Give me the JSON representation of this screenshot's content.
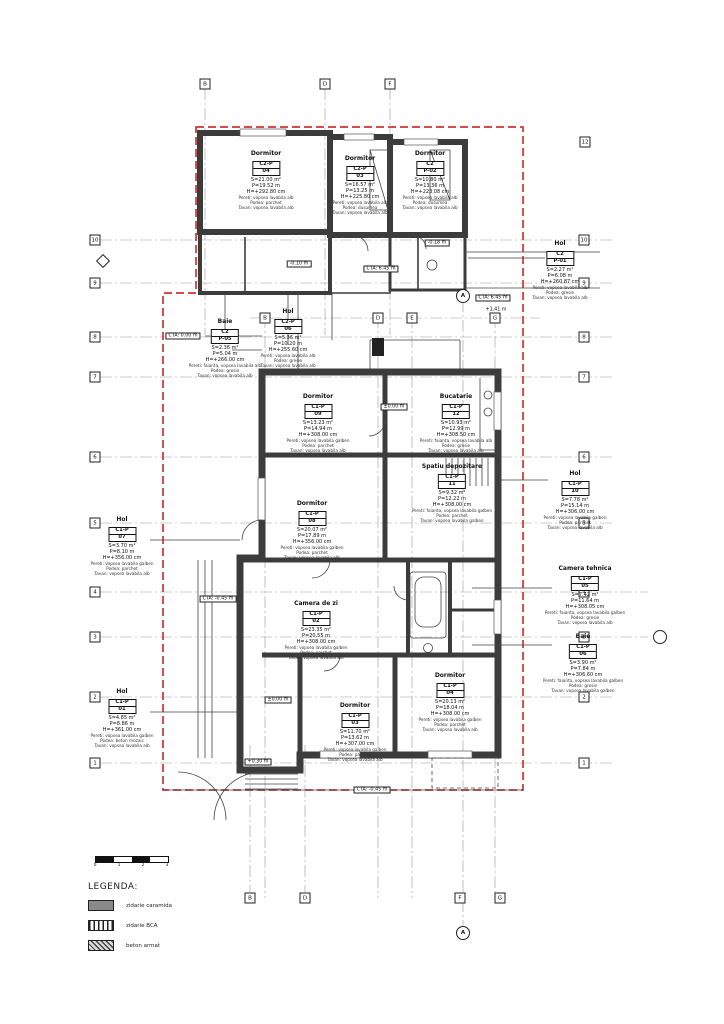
{
  "palette": {
    "boundary": "#cf3333",
    "wall": "#3c3c3c",
    "paper": "#ffffff"
  },
  "legend": {
    "title": "LEGENDA:",
    "items": [
      {
        "name": "zidarie caramida",
        "style": "solid"
      },
      {
        "name": "zidarie BCA",
        "style": "vlines"
      },
      {
        "name": "beton armat",
        "style": "hatch"
      }
    ]
  },
  "scalebar": {
    "ticks": [
      "0",
      "1",
      "2",
      "3"
    ]
  },
  "rooms": [
    {
      "name": "Dormitor",
      "code": "C2-P",
      "num": "04",
      "area": "S=21.00 m²",
      "per": "P=19.52 m",
      "h": "H=+292.80 cm",
      "f1": "Pereti: vopsea lavabila alb",
      "f2": "Podea: parchet",
      "f3": "Tavan: vopsea lavabila alb",
      "x": 266,
      "y": 150
    },
    {
      "name": "Dormitor",
      "code": "C2-P",
      "num": "03",
      "area": "S=16.57 m²",
      "per": "P=13.25 m",
      "h": "H=+225.80 cm",
      "f1": "Pereti: vopsea lavabila alb",
      "f2": "Podea: dusumea",
      "f3": "Tavan: vopsea lavabila alb",
      "x": 360,
      "y": 155
    },
    {
      "name": "Dormitor",
      "code": "C2",
      "num": "P-02",
      "area": "S=10.80 m²",
      "per": "P=13.36 m",
      "h": "H=+223.08 cm",
      "f1": "Pereti: vopsea lavabila alb",
      "f2": "Podea: dusumea",
      "f3": "Tavan: vopsea lavabila alb",
      "x": 430,
      "y": 150
    },
    {
      "name": "Hol",
      "code": "C2",
      "num": "P-01",
      "area": "S=2.27 m²",
      "per": "P=6.08 m",
      "h": "H=+260.87 cm",
      "f1": "Pereti: vopsea lavabila alb",
      "f2": "Podea: gresie",
      "f3": "Tavan: vopsea lavabila alb",
      "x": 560,
      "y": 240
    },
    {
      "name": "Baie",
      "code": "C2",
      "num": "P-05",
      "area": "S=2.36 m²",
      "per": "P=5.04 m",
      "h": "H=+266.00 cm",
      "f1": "Pereti: faianta, vopsea lavabila alb",
      "f2": "Podea: gresie",
      "f3": "Tavan: vopsea lavabila alb",
      "x": 225,
      "y": 318
    },
    {
      "name": "Hol",
      "code": "C2-P",
      "num": "06",
      "area": "S=5.36 m²",
      "per": "P=10.20 m",
      "h": "H=+255.60 cm",
      "f1": "Pereti: vopsea lavabila alb",
      "f2": "Podea: gresie",
      "f3": "Tavan: vopsea lavabila alb",
      "x": 288,
      "y": 308
    },
    {
      "name": "Dormitor",
      "code": "C1-P",
      "num": "09",
      "area": "S=13.23 m²",
      "per": "P=14.94 m",
      "h": "H=+308.00 cm",
      "f1": "Pereti: vopsea lavabila galben",
      "f2": "Podea: parchet",
      "f3": "Tavan: vopsea lavabila alb",
      "x": 318,
      "y": 393
    },
    {
      "name": "Bucatarie",
      "code": "C1-P",
      "num": "12",
      "area": "S=10.93 m²",
      "per": "P=12.99 m",
      "h": "H=+308.50 cm",
      "f1": "Pereti: faianta, vopsea lavabila alb",
      "f2": "Podea: gresie",
      "f3": "Tavan: vopsea lavabila alb",
      "x": 456,
      "y": 393
    },
    {
      "name": "Spatiu depozitare",
      "code": "C1-P",
      "num": "11",
      "area": "S=9.32 m²",
      "per": "P=12.22 m",
      "h": "H=+308.00 cm",
      "f1": "Pereti: faianta, vopsea lavabila galben",
      "f2": "Podea: parchet",
      "f3": "Tavan: vopsea lavabila galben",
      "x": 452,
      "y": 463
    },
    {
      "name": "Dormitor",
      "code": "C1-P",
      "num": "08",
      "area": "S=20.07 m²",
      "per": "P=17.89 m",
      "h": "H=+356.00 cm",
      "f1": "Pereti: vopsea lavabila galben",
      "f2": "Podea: parchet",
      "f3": "Tavan: vopsea lavabila alb",
      "x": 312,
      "y": 500
    },
    {
      "name": "Hol",
      "code": "C1-P",
      "num": "07",
      "area": "S=3.70 m²",
      "per": "P=8.10 m",
      "h": "H=+356.00 cm",
      "f1": "Pereti: vopsea lavabila galben",
      "f2": "Podea: parchet",
      "f3": "Tavan: vopsea lavabila alb",
      "x": 122,
      "y": 516
    },
    {
      "name": "Hol",
      "code": "C1-P",
      "num": "10",
      "area": "S=7.78 m²",
      "per": "P=15.14 m",
      "h": "H=+306.00 cm",
      "f1": "Pereti: vopsea lavabila galben",
      "f2": "Podea: parchet",
      "f3": "Tavan: vopsea lavabila alb",
      "x": 575,
      "y": 470
    },
    {
      "name": "Camera de zi",
      "code": "C1-P",
      "num": "02",
      "area": "S=23.35 m²",
      "per": "P=20.55 m",
      "h": "H=+308.00 cm",
      "f1": "Pereti: vopsea lavabila galben",
      "f2": "Podea: parchet",
      "f3": "Tavan: vopsea lavabila alb",
      "x": 316,
      "y": 600
    },
    {
      "name": "Camera tehnica",
      "code": "C1-P",
      "num": "05",
      "area": "S=7.42 m²",
      "per": "P=11.64 m",
      "h": "H=+308.05 cm",
      "f1": "Pereti: faianta, vopsea lavabila galben",
      "f2": "Podea: gresie",
      "f3": "Tavan: vopsea lavabila alb",
      "x": 585,
      "y": 565
    },
    {
      "name": "Baie",
      "code": "C1-P",
      "num": "06",
      "area": "S=3.90 m²",
      "per": "P=7.84 m",
      "h": "H=+306.60 cm",
      "f1": "Pereti: faianta, vopsea lavabila galben",
      "f2": "Podea: gresie",
      "f3": "Tavan: vopsea lavabila galben",
      "x": 583,
      "y": 633
    },
    {
      "name": "Hol",
      "code": "C1-P",
      "num": "01",
      "area": "S=4.85 m²",
      "per": "P=8.86 m",
      "h": "H=+361.00 cm",
      "f1": "Pereti: vopsea lavabila galben",
      "f2": "Podea: beton mozaic",
      "f3": "Tavan: vopsea lavabila alb",
      "x": 122,
      "y": 688
    },
    {
      "name": "Dormitor",
      "code": "C1-P",
      "num": "03",
      "area": "S=11.70 m²",
      "per": "P=13.62 m",
      "h": "H=+307.00 cm",
      "f1": "Pereti: vopsea lavabila galben",
      "f2": "Podea: parchet",
      "f3": "Tavan: vopsea lavabila alb",
      "x": 355,
      "y": 702
    },
    {
      "name": "Dormitor",
      "code": "C1-P",
      "num": "04",
      "area": "S=20.13 m²",
      "per": "P=18.04 m",
      "h": "H=+308.00 cm",
      "f1": "Pereti: vopsea lavabila galben",
      "f2": "Podea: parchet",
      "f3": "Tavan: vopsea lavabila alb",
      "x": 450,
      "y": 672
    }
  ],
  "levels": [
    {
      "label": "-0.10 m",
      "x": 299,
      "y": 264,
      "boxed": true
    },
    {
      "label": "-0.18 m",
      "x": 437,
      "y": 243,
      "boxed": true
    },
    {
      "label": "±0.00 m",
      "x": 394,
      "y": 407,
      "boxed": true
    },
    {
      "label": "±0.00 m",
      "x": 278,
      "y": 700,
      "boxed": true
    },
    {
      "label": "+0.30 m",
      "x": 258,
      "y": 762,
      "boxed": true
    },
    {
      "label": "CTA: 6.45 m",
      "x": 381,
      "y": 269,
      "boxed": true
    },
    {
      "label": "CTA: 6.45 m",
      "x": 493,
      "y": 298,
      "boxed": true
    },
    {
      "label": "CTA: 0.00 m",
      "x": 183,
      "y": 336,
      "boxed": true
    },
    {
      "label": "CTA: -0.45 m",
      "x": 218,
      "y": 599,
      "boxed": true
    },
    {
      "label": "CTA: -0.45 m",
      "x": 372,
      "y": 790,
      "boxed": true
    },
    {
      "label": "+1.41 m",
      "x": 496,
      "y": 310,
      "boxed": false
    }
  ],
  "grid_bubbles": [
    {
      "label": "B",
      "x": 205,
      "y": 84
    },
    {
      "label": "D",
      "x": 325,
      "y": 84
    },
    {
      "label": "F",
      "x": 390,
      "y": 84
    },
    {
      "label": "12",
      "x": 585,
      "y": 142
    },
    {
      "label": "B",
      "x": 265,
      "y": 318
    },
    {
      "label": "D",
      "x": 378,
      "y": 318
    },
    {
      "label": "E",
      "x": 412,
      "y": 318
    },
    {
      "label": "G",
      "x": 495,
      "y": 318
    },
    {
      "label": "10",
      "x": 95,
      "y": 240
    },
    {
      "label": "9",
      "x": 95,
      "y": 283
    },
    {
      "label": "8",
      "x": 95,
      "y": 337
    },
    {
      "label": "7",
      "x": 95,
      "y": 377
    },
    {
      "label": "6",
      "x": 95,
      "y": 457
    },
    {
      "label": "5",
      "x": 95,
      "y": 523
    },
    {
      "label": "4",
      "x": 95,
      "y": 592
    },
    {
      "label": "3",
      "x": 95,
      "y": 637
    },
    {
      "label": "2",
      "x": 95,
      "y": 697
    },
    {
      "label": "1",
      "x": 95,
      "y": 763
    },
    {
      "label": "10",
      "x": 584,
      "y": 240
    },
    {
      "label": "9",
      "x": 584,
      "y": 283
    },
    {
      "label": "8",
      "x": 584,
      "y": 337
    },
    {
      "label": "7",
      "x": 584,
      "y": 377
    },
    {
      "label": "6",
      "x": 584,
      "y": 457
    },
    {
      "label": "5",
      "x": 584,
      "y": 523
    },
    {
      "label": "4",
      "x": 584,
      "y": 592
    },
    {
      "label": "3",
      "x": 584,
      "y": 637
    },
    {
      "label": "2",
      "x": 584,
      "y": 697
    },
    {
      "label": "1",
      "x": 584,
      "y": 763
    },
    {
      "label": "B",
      "x": 250,
      "y": 898
    },
    {
      "label": "D",
      "x": 305,
      "y": 898
    },
    {
      "label": "F",
      "x": 460,
      "y": 898
    },
    {
      "label": "G",
      "x": 500,
      "y": 898
    }
  ],
  "markers": [
    {
      "type": "diamond",
      "label": "",
      "x": 103,
      "y": 261
    },
    {
      "type": "circle",
      "label": "",
      "x": 660,
      "y": 637
    },
    {
      "type": "circle",
      "label": "A",
      "x": 463,
      "y": 296
    },
    {
      "type": "circle",
      "label": "A",
      "x": 463,
      "y": 933
    }
  ]
}
